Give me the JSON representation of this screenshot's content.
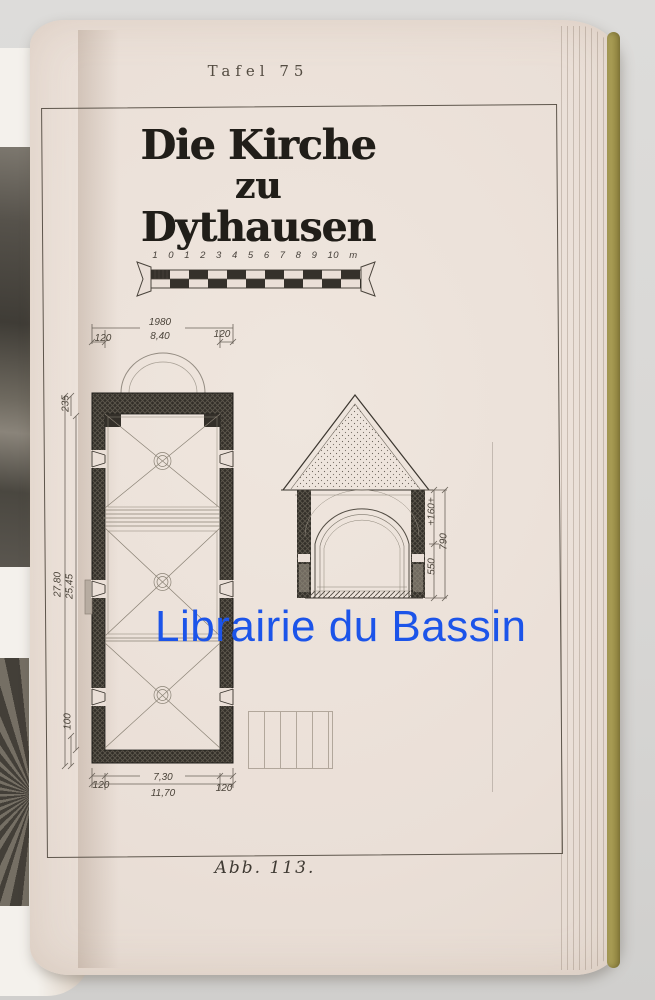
{
  "header": {
    "plate_label": "Tafel 75"
  },
  "plate": {
    "title": {
      "line1": "Die Kirche",
      "line2": "zu",
      "line3": "Dythausen"
    },
    "scale_numbers": "1 0 1 2 3 4 5 6 7 8 9 10 m",
    "caption": "Abb. 113."
  },
  "floor_plan_dims": {
    "top_margin_left": "120",
    "top_width_outer": "1980",
    "top_width_inner": "8,40",
    "top_margin_right": "120",
    "side_upper": "235",
    "side_total": "27,80",
    "side_inner": "25,45",
    "side_lower": "100",
    "bottom_margin_left": "120",
    "bottom_width_inner": "7,30",
    "bottom_width_total": "11,70",
    "bottom_margin_right": "120"
  },
  "section_dims": {
    "lower_height": "550",
    "upper_height": "+160+",
    "total_height": "790"
  },
  "watermark": {
    "text": "Librairie du Bassin",
    "color": "#1c54e9"
  },
  "colors": {
    "background": "#d7d6d4",
    "page": "#eadfd7",
    "ink": "#3a352e",
    "frame": "#5e564c",
    "fore_edge": "#a79b52",
    "watermark_blue": "#1c54e9"
  }
}
